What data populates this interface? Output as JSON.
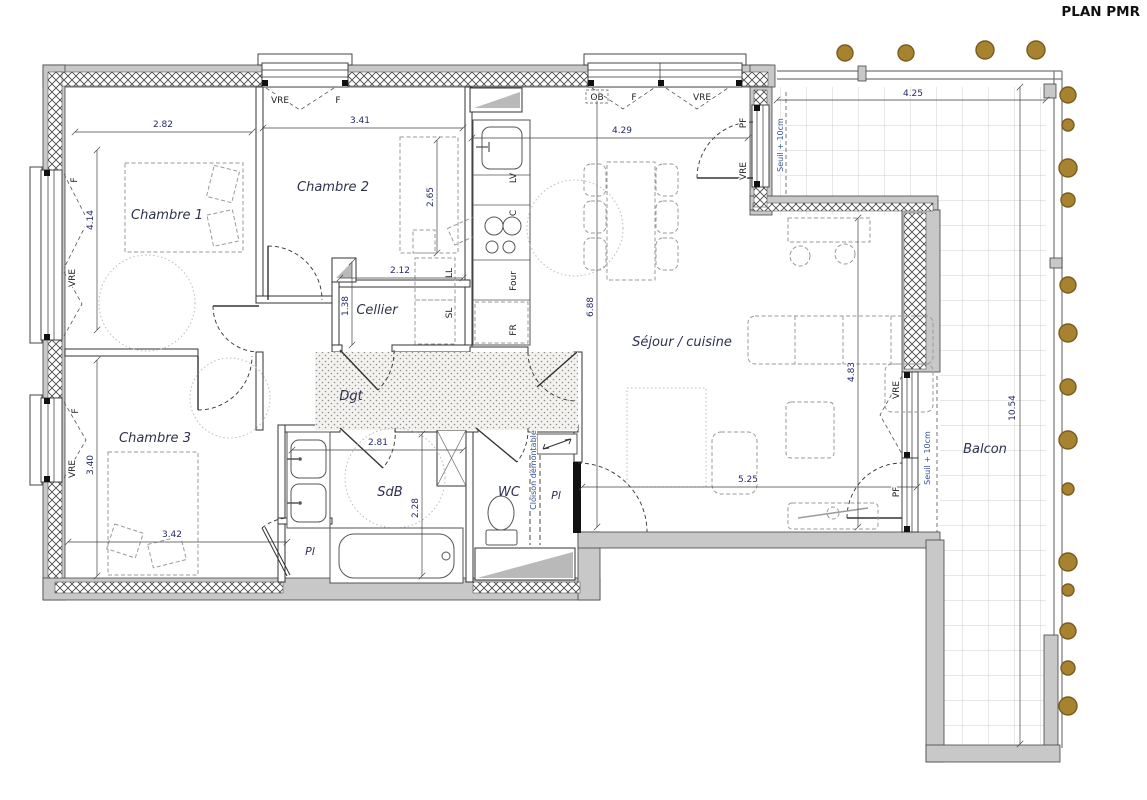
{
  "title": "PLAN PMR",
  "rooms": {
    "chambre1": "Chambre 1",
    "chambre2": "Chambre 2",
    "chambre3": "Chambre 3",
    "cellier": "Cellier",
    "sejour": "Séjour / cuisine",
    "dgt": "Dgt",
    "sdb": "SdB",
    "wc": "WC",
    "balcon": "Balcon",
    "placard_wc": "Pl",
    "placard_ch3": "Pl"
  },
  "appliances": {
    "lv": "LV",
    "c": "C",
    "four": "Four",
    "fr": "FR",
    "ll": "LL",
    "sl": "SL"
  },
  "openings": {
    "vre": "VRE",
    "f": "F",
    "ob": "OB",
    "pf": "PF"
  },
  "notes": {
    "seuil": "Seuil + 10cm",
    "cloison": "Cloison démontable"
  },
  "dimensions": {
    "ch1_w": "2.82",
    "ch1_h": "4.14",
    "ch2_w": "3.41",
    "ch2_bed": "2.65",
    "cellier_w": "2.12",
    "cellier_h": "1.38",
    "kitchen_w": "4.29",
    "sejour_h": "6.88",
    "sejour_e_h": "4.83",
    "sejour_s_w": "5.25",
    "ch3_h": "3.40",
    "ch3_w": "3.42",
    "sdb_w": "2.81",
    "sdb_h": "2.28",
    "balcony_n_w": "4.25",
    "balcony_e_h": "10.54"
  },
  "colors": {
    "wall_grey": "#c8c8c8",
    "planter_dot": "#a8832f",
    "dim_text": "#232a66",
    "label_text": "#2e3150"
  }
}
